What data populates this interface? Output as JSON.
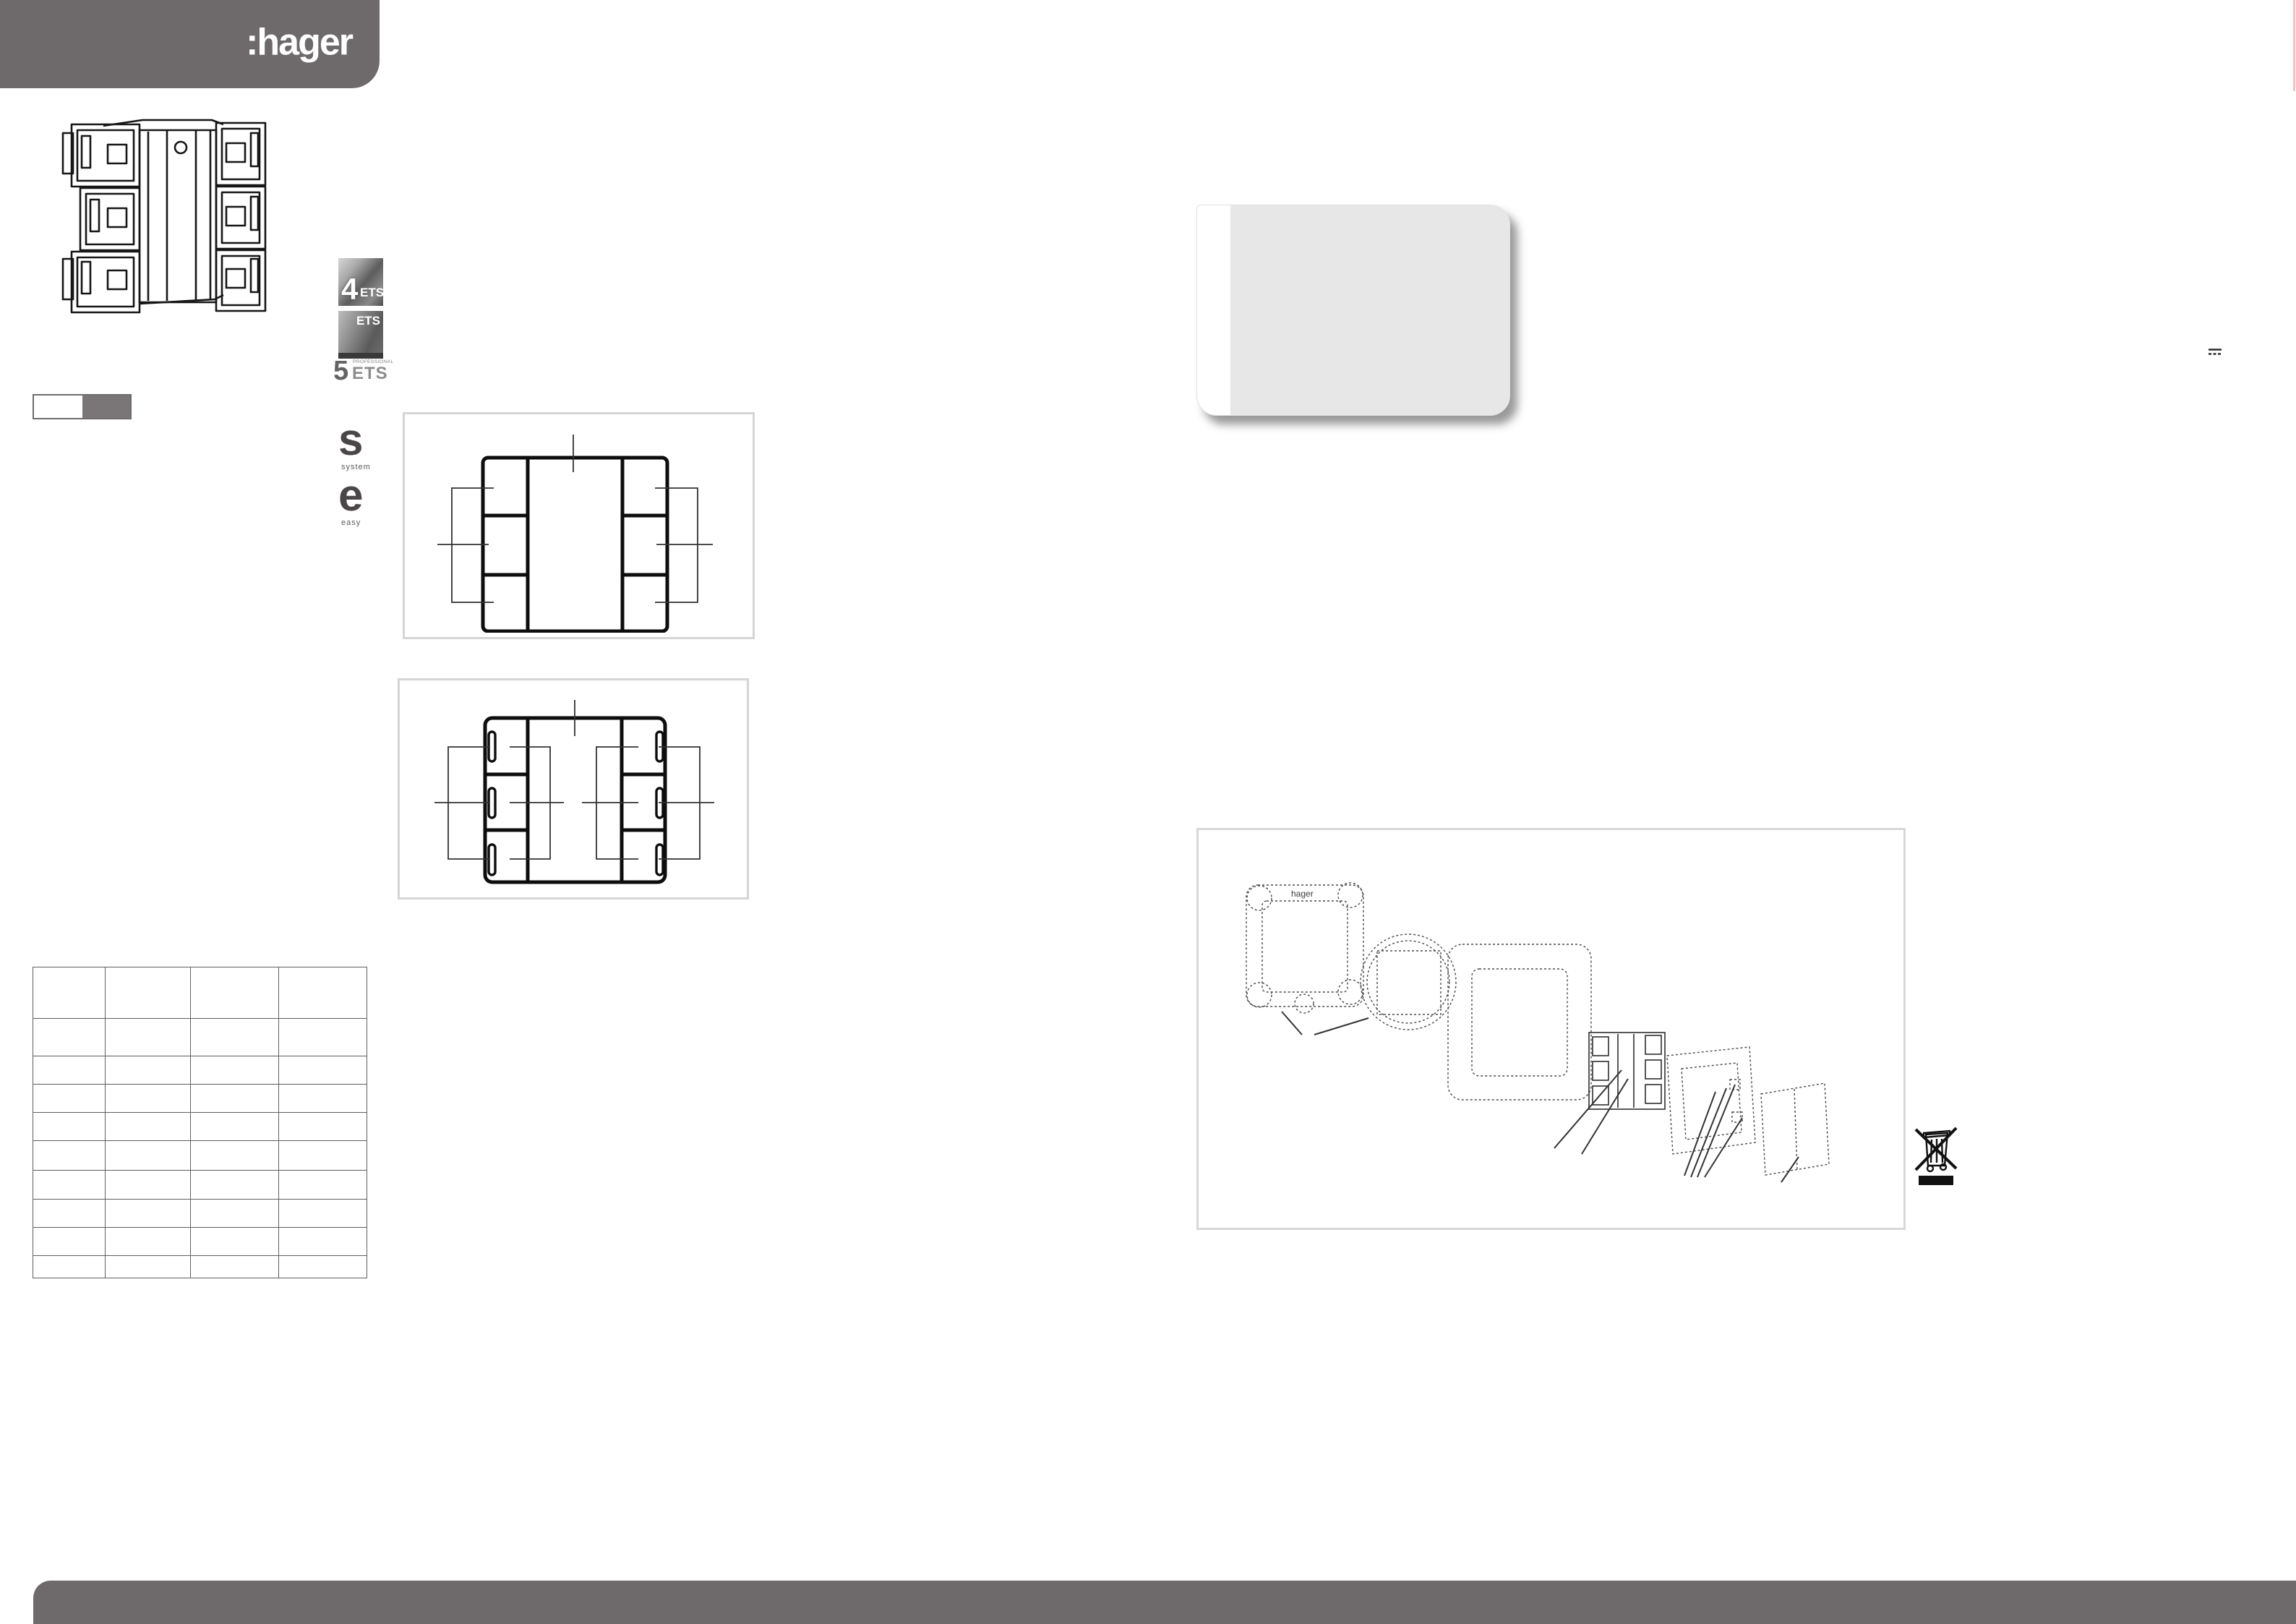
{
  "header": {
    "logo": ":hager",
    "bar_color": "#6e6a6b"
  },
  "footer": {
    "bar_color": "#6e6a6b"
  },
  "product": {
    "description": "KNX 6-gang push-button flush module line drawing"
  },
  "ets_badges": {
    "ets4": {
      "number": "4",
      "text": "ETS"
    },
    "ets_photo": {
      "text": "ETS"
    },
    "ets5": {
      "number": "5",
      "professional": "PROFESSIONAL",
      "text": "ETS"
    }
  },
  "range_logos": {
    "system": {
      "glyph": "s",
      "caption": "system"
    },
    "easy": {
      "glyph": "e",
      "caption": "easy"
    }
  },
  "color_swatch": {
    "left_hex": "#ffffff",
    "right_hex": "#7a7677"
  },
  "table": {
    "rows": [
      [
        "",
        "",
        "",
        ""
      ],
      [
        "",
        "",
        "",
        ""
      ],
      [
        "",
        "",
        "",
        ""
      ],
      [
        "",
        "",
        "",
        ""
      ],
      [
        "",
        "",
        "",
        ""
      ],
      [
        "",
        "",
        "",
        ""
      ],
      [
        "",
        "",
        "",
        ""
      ],
      [
        "",
        "",
        "",
        ""
      ],
      [
        "",
        "",
        "",
        ""
      ],
      [
        "",
        "",
        "",
        ""
      ]
    ]
  },
  "card": {
    "note": ""
  },
  "symbols": {
    "dc": "dc-voltage",
    "weee": "crossed-out-wheelie-bin"
  },
  "exploded_view": {
    "plate_label": "hager"
  },
  "colors": {
    "bar": "#6e6a6b",
    "card_grey": "#e8e7e7",
    "diagram_border": "#d6d4d4",
    "swatch_grey": "#7a7677"
  }
}
